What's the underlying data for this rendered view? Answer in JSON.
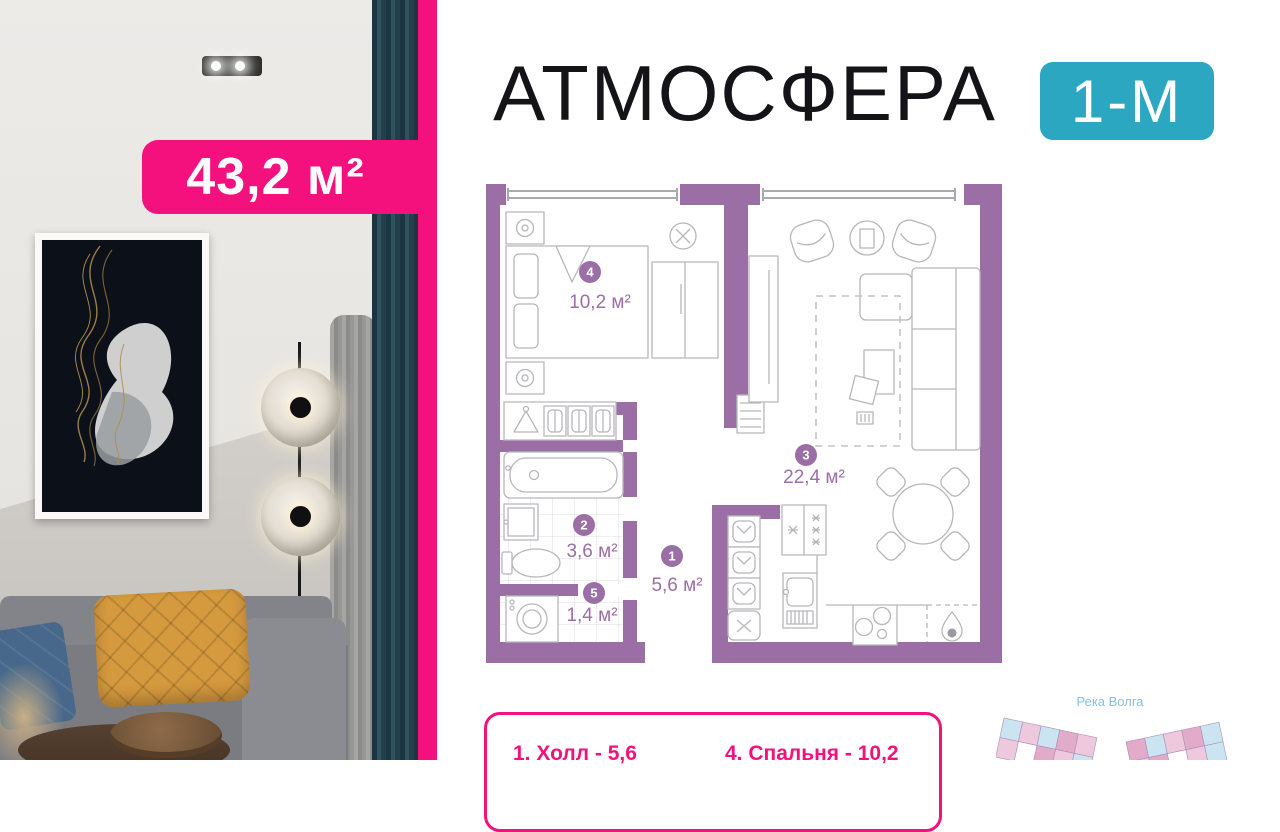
{
  "brand": {
    "title": "АТМОСФЕРА",
    "unit_type": "1-М"
  },
  "area_badge": {
    "label": "43,2 м²"
  },
  "floor_plan": {
    "rooms": [
      {
        "number": "1",
        "area": "5,6 м²"
      },
      {
        "number": "2",
        "area": "3,6 м²"
      },
      {
        "number": "3",
        "area": "22,4 м²"
      },
      {
        "number": "4",
        "area": "10,2 м²"
      },
      {
        "number": "5",
        "area": "1,4 м²"
      }
    ]
  },
  "legend": {
    "items": [
      "1. Холл - 5,6",
      "4. Спальня - 10,2"
    ]
  },
  "site_plan": {
    "river_label": "Река Волга"
  },
  "colors": {
    "pink": "#F4117E",
    "teal": "#2BA7C1",
    "plan_purple": "#9B6FA6",
    "site_pink_light": "#eec9de",
    "site_pink_dark": "#e2abc9",
    "site_blue": "#cbe4f1"
  }
}
